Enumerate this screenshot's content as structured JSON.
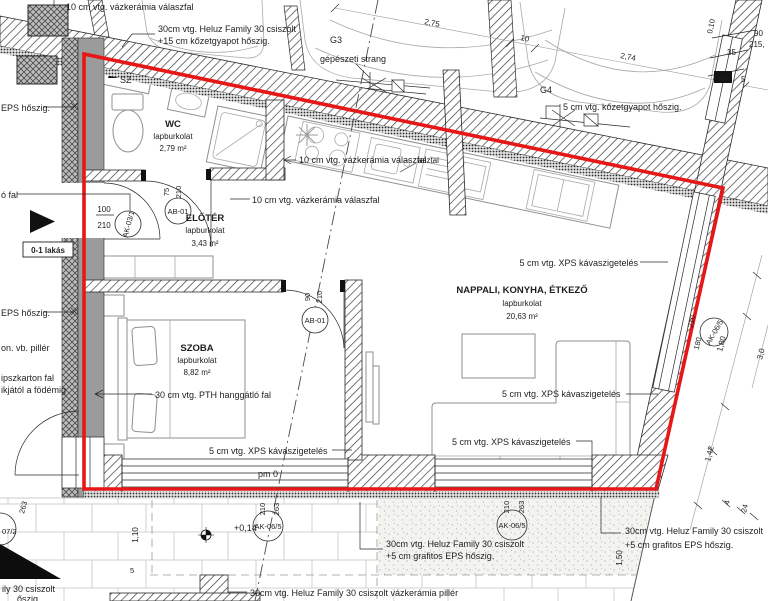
{
  "drawing": {
    "apartment_label": "0-1 lakás",
    "rooms": {
      "wc": {
        "name": "WC",
        "finish": "lapburkolat",
        "area": "2,79 m²"
      },
      "eloter": {
        "name": "ELŐTÉR",
        "finish": "lapburkolat",
        "area": "3,43 m²"
      },
      "szoba": {
        "name": "SZOBA",
        "finish": "lapburkolat",
        "area": "8,82 m²"
      },
      "nappali": {
        "name": "NAPPALI, KONYHA, ÉTKEZŐ",
        "finish": "lapburkolat",
        "area": "20,63 m²"
      }
    },
    "wall_labels": {
      "vazkeramia_10": "10 cm vtg. vázkerámia válaszfal",
      "heluz_kozetgyapot_line1": "30cm vtg. Heluz Family 30 csiszolt",
      "heluz_kozetgyapot_line2": "+15 cm kőzetgyapot hőszig.",
      "kozetgyapot_5": "5 cm vtg. kőzetgyapot hőszig.",
      "eps": "EPS hőszig.",
      "o_fal": "ó fal",
      "vb_piller": "on. vb. pillér",
      "gipszkarton_line1": "ipszkarton fal",
      "gipszkarton_line2": "ikjától a födémig",
      "pth": "30 cm vtg. PTH hanggátló fal",
      "xps": "5 cm vtg. XPS kávaszigetelés",
      "heluz_grafitos_line1": "30cm vtg. Heluz Family 30 csiszolt",
      "heluz_grafitos_line2": "+5 cm grafitos EPS hőszig.",
      "heluz_piller": "30cm vtg. Heluz Family 30 csiszolt vázkerámia pillér",
      "partial_csiszolt": "ily 30 csiszolt",
      "partial_hoszig": "őszig.",
      "gepeszeti_strang": "gépészeti strang",
      "asztal": "asztal",
      "sz": "SZ"
    },
    "markers": {
      "ab01": "AB-01",
      "ak03": "AK-03/1",
      "ak06": "AK-06/5",
      "ak07_partial": "07/2"
    },
    "parking": {
      "g3": "G3",
      "g4": "G4",
      "dim_g3": "2,75",
      "dim_g4": "2,74",
      "dim_wall": "10"
    },
    "levels": {
      "terrace": "+0,14",
      "floor": "pm 0"
    },
    "dims": {
      "d100": "100",
      "d210": "210",
      "d75": "75",
      "d90": "90",
      "d263": "263",
      "d215": "215,",
      "d35": "35",
      "d30": "30",
      "d5": "5",
      "d010": "0,10",
      "d180": "180",
      "d1_80": "1,80",
      "d1_42": "1,42",
      "d3_0": "3,0",
      "d4": "4",
      "d24": "24",
      "d1_10": "1,10",
      "d1_50": "1,50"
    },
    "colors": {
      "boundary_red": "#e61717",
      "wall_dark": "#2a2a2a",
      "gray_fill": "#9b9b9b"
    }
  }
}
